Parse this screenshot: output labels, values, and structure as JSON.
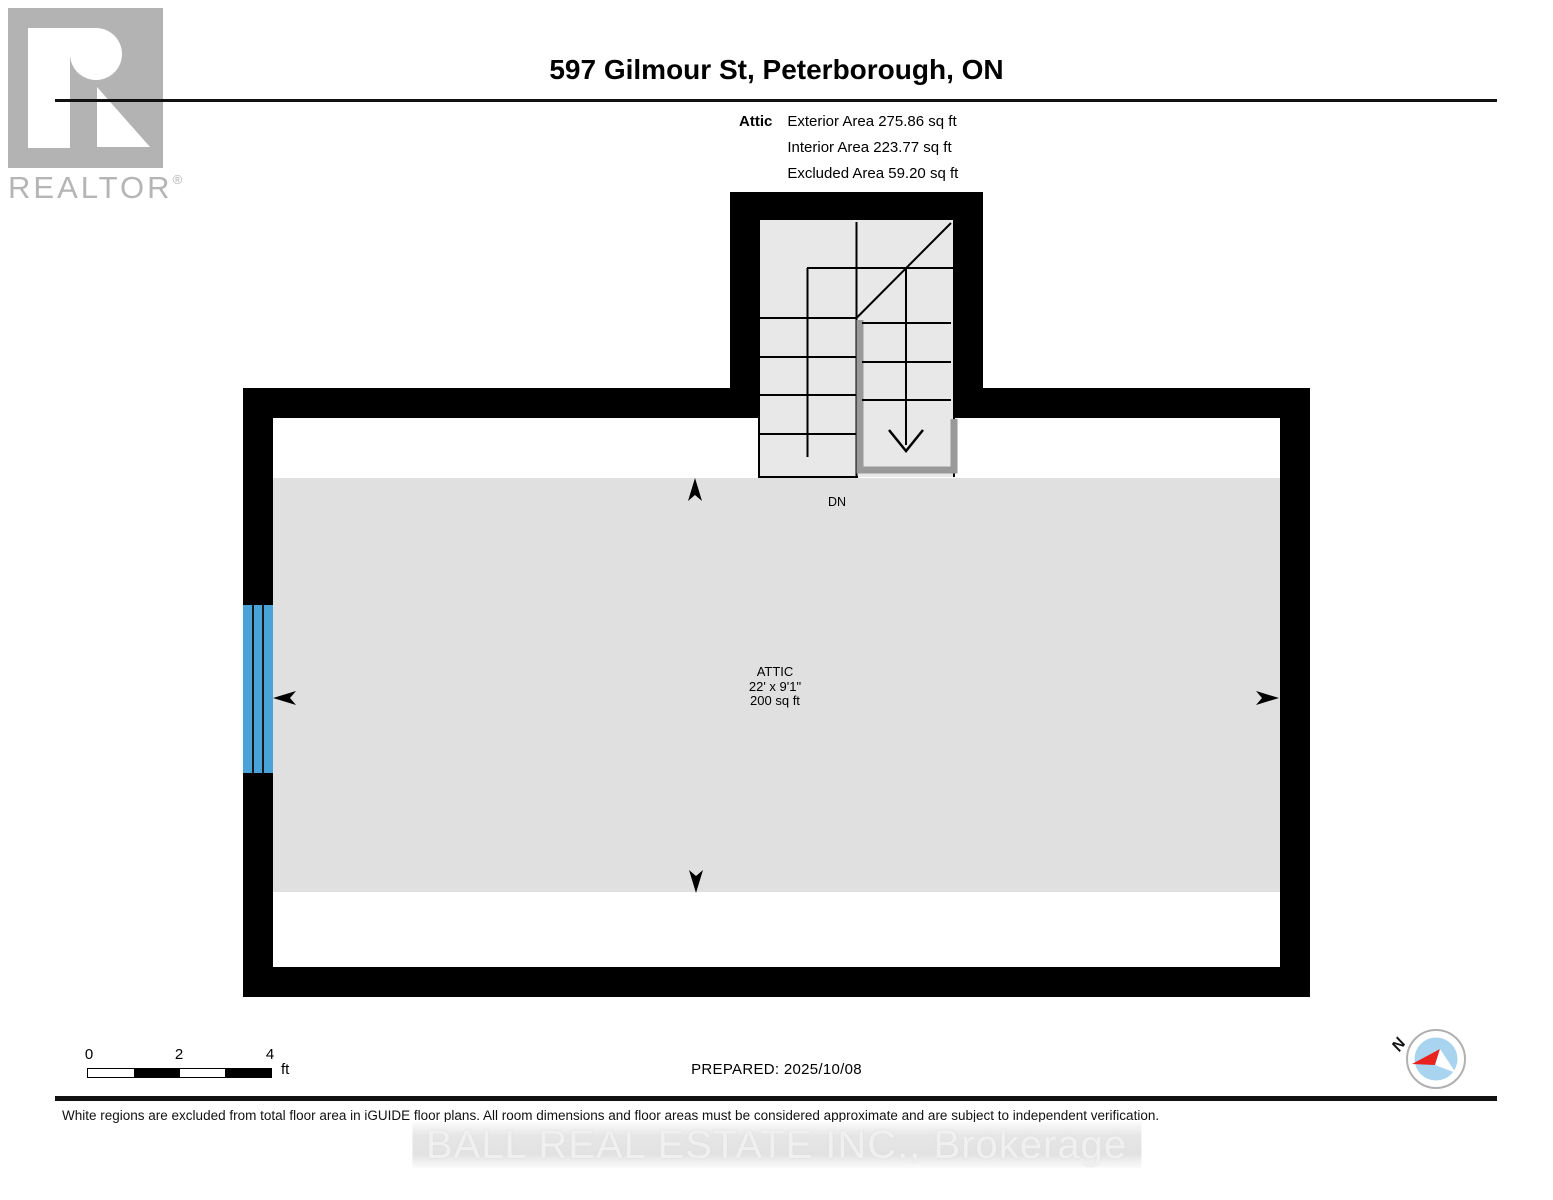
{
  "branding": {
    "realtor_logo_text": "REALTOR",
    "registered_mark": "®",
    "watermark": "BALL REAL ESTATE INC., Brokerage"
  },
  "header": {
    "title": "597 Gilmour St, Peterborough, ON",
    "floor_label": "Attic",
    "area_lines": [
      "Exterior Area 275.86 sq ft",
      "Interior Area 223.77 sq ft",
      "Excluded Area 59.20 sq ft"
    ]
  },
  "plan": {
    "stair_label": "DN",
    "room": {
      "name": "ATTIC",
      "dimensions": "22' x 9'1\"",
      "area": "200 sq ft"
    }
  },
  "footer": {
    "scale": {
      "ticks": [
        "0",
        "2",
        "4"
      ],
      "unit": "ft"
    },
    "prepared": "PREPARED: 2025/10/08",
    "compass_north": "N",
    "disclaimer": "White regions are excluded from total floor area in iGUIDE floor plans. All room dimensions and floor areas must be considered approximate and are subject to independent verification."
  },
  "colors": {
    "wall": "#000000",
    "floor_gray": "#e0e0e0",
    "stair_gray": "#e8e8e8",
    "railing_gray": "#999999",
    "window_blue": "#4aa3d8",
    "logo_gray": "#b3b3b3",
    "watermark_gray": "#f0f0f0",
    "compass_blue": "#a8d4ef",
    "compass_red": "#e8231f"
  }
}
